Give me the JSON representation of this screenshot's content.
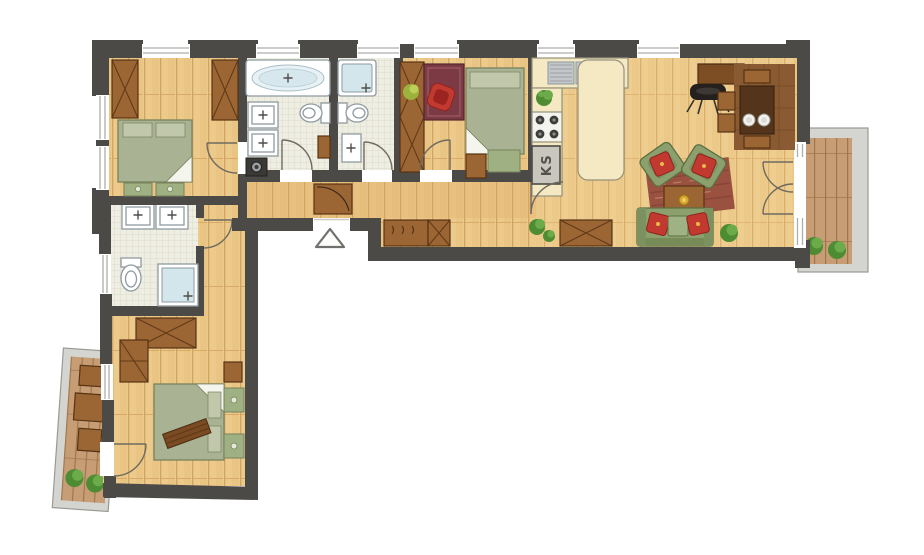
{
  "title": "Apartment floor plan",
  "labels": {
    "fridge": "KS"
  },
  "entrance_marker": "triangle-up",
  "colors": {
    "wall": "#4b4a47",
    "window_line": "#aeaeaa",
    "wood": "#ecca8c",
    "wood_line": "#d3a45f",
    "wood_warm": "#e0ab64",
    "tile": "#efeee2",
    "tile_line": "#d9d5c3",
    "counter": "#f4e9c3",
    "counter_edge": "#96917a",
    "fixture_edge": "#8e9aa0",
    "shower_blue": "#d3e6ec",
    "steel": "#c3c7c9",
    "railing": "#d4d4d1",
    "railing_edge": "#999995",
    "deck": "#c79d75",
    "deck_line": "#a0774b",
    "bed_green": "#a9b394",
    "bed_green_dark": "#78825d",
    "bed_pillow": "#c0c7aa",
    "sofa_green": "#8ba06d",
    "sofa_edge": "#5c6f42",
    "pillow_red": "#c23a2f",
    "rug_brick": "#9a5140",
    "rug_red": "#7c3b44",
    "rug_brown": "#8a5a33",
    "furniture_wood": "#9c6534",
    "furniture_wood_dark": "#573414",
    "table_dark": "#54341a",
    "plant": "#4e8c33",
    "plant_light": "#6cab49",
    "appliance": "#c9c7bd",
    "door_line": "#6f6a60"
  },
  "rooms": [
    {
      "name": "bedroom-1",
      "furniture": [
        "wardrobe",
        "wardrobe",
        "double-bed",
        "foot-benches"
      ]
    },
    {
      "name": "bathroom-1",
      "furniture": [
        "bathtub",
        "double-washbasin",
        "toilet",
        "washing-machine",
        "cabinet"
      ]
    },
    {
      "name": "bathroom-2",
      "furniture": [
        "shower",
        "toilet",
        "washbasin"
      ]
    },
    {
      "name": "bedroom-2",
      "furniture": [
        "wardrobe",
        "rug",
        "desk-chair",
        "single-bed",
        "bench",
        "plant"
      ]
    },
    {
      "name": "kitchen",
      "furniture": [
        "sink-counter",
        "stove",
        "refrigerator",
        "island-counter",
        "plant"
      ]
    },
    {
      "name": "living-dining-room",
      "furniture": [
        "tv-console",
        "side-table",
        "dining-table",
        "chairs",
        "plates",
        "dining-rug",
        "sofa",
        "armchair",
        "armchair",
        "coffee-table",
        "rug",
        "chest",
        "plants"
      ]
    },
    {
      "name": "hallway",
      "furniture": [
        "entrance-door",
        "closet",
        "coat-bench",
        "chest",
        "plants"
      ]
    },
    {
      "name": "bathroom-3",
      "furniture": [
        "double-washbasin",
        "toilet",
        "shower"
      ]
    },
    {
      "name": "bedroom-3",
      "furniture": [
        "wardrobe",
        "double-bed",
        "nightstands",
        "chest",
        "blanket-roll"
      ]
    },
    {
      "name": "balcony-right",
      "furniture": [
        "plants"
      ]
    },
    {
      "name": "balcony-left",
      "furniture": [
        "table",
        "stools",
        "plants"
      ]
    }
  ]
}
